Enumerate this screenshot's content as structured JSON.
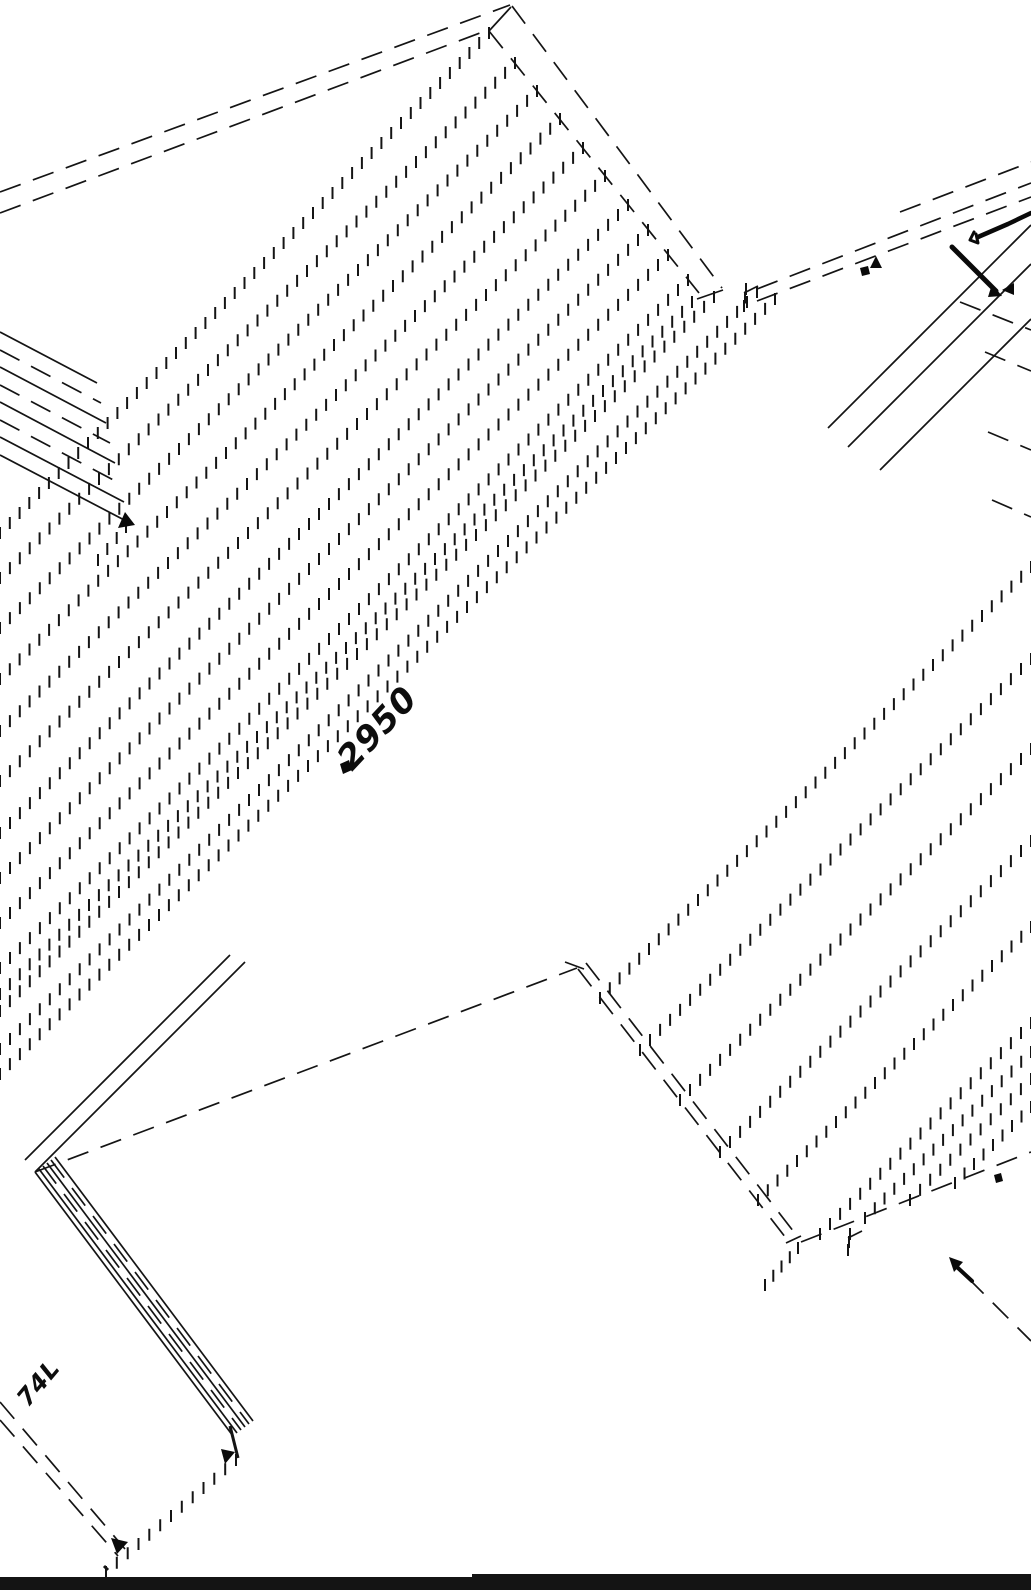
{
  "canvas": {
    "w": 1031,
    "h": 1590,
    "bg": "#ffffff",
    "ink": "#141414"
  },
  "drawing": {
    "dash_lines": [
      {
        "x1": 0,
        "y1": 192,
        "x2": 510,
        "y2": 5
      },
      {
        "x1": 0,
        "y1": 213,
        "x2": 488,
        "y2": 30
      },
      {
        "x1": 512,
        "y1": 6,
        "x2": 722,
        "y2": 288
      },
      {
        "x1": 489,
        "y1": 31,
        "x2": 699,
        "y2": 293
      },
      {
        "x1": 35,
        "y1": 1172,
        "x2": 577,
        "y2": 968
      },
      {
        "x1": 578,
        "y1": 969,
        "x2": 789,
        "y2": 1242
      },
      {
        "x1": 586,
        "y1": 963,
        "x2": 797,
        "y2": 1236
      },
      {
        "x1": 801,
        "y1": 1242,
        "x2": 1031,
        "y2": 1152
      },
      {
        "x1": 757,
        "y1": 289,
        "x2": 1031,
        "y2": 183
      },
      {
        "x1": 757,
        "y1": 301,
        "x2": 1031,
        "y2": 197
      },
      {
        "x1": 900,
        "y1": 212,
        "x2": 1031,
        "y2": 162
      },
      {
        "x1": 0,
        "y1": 1402,
        "x2": 125,
        "y2": 1549
      },
      {
        "x1": 0,
        "y1": 1420,
        "x2": 118,
        "y2": 1556
      },
      {
        "x1": 968,
        "y1": 1278,
        "x2": 1031,
        "y2": 1341
      },
      {
        "x1": 960,
        "y1": 302,
        "x2": 1031,
        "y2": 330
      },
      {
        "x1": 985,
        "y1": 352,
        "x2": 1031,
        "y2": 371
      },
      {
        "x1": 988,
        "y1": 432,
        "x2": 1031,
        "y2": 450
      },
      {
        "x1": 992,
        "y1": 500,
        "x2": 1031,
        "y2": 517
      },
      {
        "x1": 0,
        "y1": 350,
        "x2": 101,
        "y2": 403
      },
      {
        "x1": 0,
        "y1": 385,
        "x2": 110,
        "y2": 443
      },
      {
        "x1": 0,
        "y1": 420,
        "x2": 119,
        "y2": 483
      },
      {
        "x1": 43,
        "y1": 1166,
        "x2": 241,
        "y2": 1430
      },
      {
        "x1": 51,
        "y1": 1160,
        "x2": 249,
        "y2": 1424
      }
    ],
    "solid_lines": [
      {
        "x1": 489,
        "y1": 31,
        "x2": 511,
        "y2": 7
      },
      {
        "x1": 697,
        "y1": 299,
        "x2": 723,
        "y2": 290
      },
      {
        "x1": 565,
        "y1": 962,
        "x2": 584,
        "y2": 969
      },
      {
        "x1": 786,
        "y1": 1243,
        "x2": 801,
        "y2": 1236
      },
      {
        "x1": 744,
        "y1": 293,
        "x2": 758,
        "y2": 286
      },
      {
        "x1": 848,
        "y1": 1238,
        "x2": 862,
        "y2": 1231
      },
      {
        "x1": 245,
        "y1": 962,
        "x2": 35,
        "y2": 1172
      },
      {
        "x1": 230,
        "y1": 955,
        "x2": 25,
        "y2": 1160
      },
      {
        "x1": 828,
        "y1": 428,
        "x2": 1031,
        "y2": 225
      },
      {
        "x1": 848,
        "y1": 447,
        "x2": 1031,
        "y2": 264
      },
      {
        "x1": 880,
        "y1": 470,
        "x2": 1031,
        "y2": 319
      },
      {
        "x1": 0,
        "y1": 332,
        "x2": 97,
        "y2": 383
      },
      {
        "x1": 0,
        "y1": 367,
        "x2": 106,
        "y2": 423
      },
      {
        "x1": 0,
        "y1": 402,
        "x2": 115,
        "y2": 463
      },
      {
        "x1": 0,
        "y1": 437,
        "x2": 124,
        "y2": 502
      },
      {
        "x1": 0,
        "y1": 455,
        "x2": 128,
        "y2": 522
      },
      {
        "x1": 35,
        "y1": 1172,
        "x2": 233,
        "y2": 1436
      },
      {
        "x1": 39,
        "y1": 1169,
        "x2": 237,
        "y2": 1433
      },
      {
        "x1": 47,
        "y1": 1163,
        "x2": 245,
        "y2": 1427
      },
      {
        "x1": 55,
        "y1": 1157,
        "x2": 253,
        "y2": 1421
      },
      {
        "x1": 230,
        "y1": 1426,
        "x2": 238,
        "y2": 1458,
        "w": 3
      },
      {
        "x1": 104,
        "y1": 1566,
        "x2": 108,
        "y2": 1570,
        "w": 3
      }
    ],
    "tick_lines": [
      {
        "x1": 489,
        "y1": 33,
        "x2": 0,
        "y2": 533
      },
      {
        "x1": 515,
        "y1": 63,
        "x2": 0,
        "y2": 578
      },
      {
        "x1": 537,
        "y1": 91,
        "x2": 0,
        "y2": 628
      },
      {
        "x1": 560,
        "y1": 119,
        "x2": 0,
        "y2": 679
      },
      {
        "x1": 583,
        "y1": 148,
        "x2": 0,
        "y2": 731
      },
      {
        "x1": 605,
        "y1": 176,
        "x2": 0,
        "y2": 781
      },
      {
        "x1": 628,
        "y1": 205,
        "x2": 0,
        "y2": 833
      },
      {
        "x1": 648,
        "y1": 230,
        "x2": 0,
        "y2": 878
      },
      {
        "x1": 668,
        "y1": 255,
        "x2": 0,
        "y2": 923
      },
      {
        "x1": 688,
        "y1": 280,
        "x2": 0,
        "y2": 968
      },
      {
        "x1": 692,
        "y1": 302,
        "x2": 0,
        "y2": 994
      },
      {
        "x1": 714,
        "y1": 297,
        "x2": 0,
        "y2": 1011
      },
      {
        "x1": 757,
        "y1": 292,
        "x2": 0,
        "y2": 1049
      },
      {
        "x1": 775,
        "y1": 299,
        "x2": 0,
        "y2": 1074
      },
      {
        "x1": 1031,
        "y1": 567,
        "x2": 600,
        "y2": 998
      },
      {
        "x1": 1031,
        "y1": 659,
        "x2": 640,
        "y2": 1050
      },
      {
        "x1": 1031,
        "y1": 749,
        "x2": 680,
        "y2": 1100
      },
      {
        "x1": 1031,
        "y1": 841,
        "x2": 720,
        "y2": 1152
      },
      {
        "x1": 1031,
        "y1": 927,
        "x2": 758,
        "y2": 1200
      },
      {
        "x1": 1031,
        "y1": 1023,
        "x2": 820,
        "y2": 1234
      },
      {
        "x1": 1031,
        "y1": 1052,
        "x2": 865,
        "y2": 1218
      },
      {
        "x1": 1031,
        "y1": 1079,
        "x2": 910,
        "y2": 1200
      },
      {
        "x1": 1031,
        "y1": 1107,
        "x2": 955,
        "y2": 1183
      },
      {
        "x1": 236,
        "y1": 1460,
        "x2": 106,
        "y2": 1572
      },
      {
        "x1": 126,
        "y1": 527,
        "x2": 98,
        "y2": 560
      },
      {
        "x1": 746,
        "y1": 289,
        "x2": 744,
        "y2": 306
      },
      {
        "x1": 850,
        "y1": 1234,
        "x2": 848,
        "y2": 1250
      },
      {
        "x1": 798,
        "y1": 1248,
        "x2": 765,
        "y2": 1285
      }
    ],
    "pen_strokes": [
      {
        "pts": "978,237 1008,224 1031,213",
        "w": 4.5
      },
      {
        "pts": "974,232 970,240 978,243 976,234",
        "w": 3
      },
      {
        "pts": "952,247 996,291",
        "w": 5
      },
      {
        "pts": "958,1268 972,1281",
        "w": 4
      }
    ],
    "arrowheads": [
      {
        "points": "125,512 135,525 118,528"
      },
      {
        "points": "221,1449 235,1452 225,1464"
      },
      {
        "points": "111,1538 128,1542 117,1554"
      },
      {
        "points": "992,284 1002,296 988,297"
      },
      {
        "points": "1014,283 1002,290 1014,295"
      },
      {
        "points": "949,1257 963,1262 954,1272"
      },
      {
        "points": "876,256 882,268 870,268"
      },
      {
        "points": "860,268 868,266 870,274 862,276"
      },
      {
        "points": "994,1175 1001,1173 1003,1181 996,1183"
      },
      {
        "points": "340,764 349,760 352,770 343,774"
      }
    ],
    "footer_bars": [
      {
        "x": 0,
        "y": 1577,
        "w": 472,
        "h": 13
      },
      {
        "x": 472,
        "y": 1574,
        "w": 559,
        "h": 16
      }
    ]
  },
  "annotations": {
    "center_dimension": {
      "text": "2950",
      "x": 352,
      "y": 772,
      "rotate": -47,
      "size": 34
    },
    "corner_dimension": {
      "text": "74L",
      "x": 28,
      "y": 1408,
      "rotate": -50,
      "size": 24
    }
  }
}
